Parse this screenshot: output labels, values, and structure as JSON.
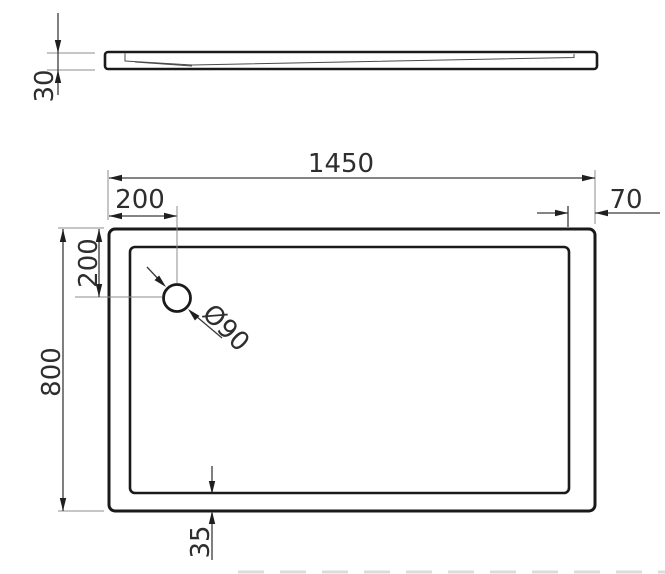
{
  "drawing": {
    "type": "technical-drawing",
    "subject": "rectangular shower tray, side profile and plan view with drain",
    "units_implied": "mm",
    "colors": {
      "background": "#ffffff",
      "outline": "#1a1a1a",
      "dimension_line": "#3a3a3a",
      "extension_line": "#8c8c8c",
      "text": "#2e2e2e"
    },
    "dimensions": {
      "side_thickness": "30",
      "overall_width": "1450",
      "drain_offset_x": "200",
      "drain_offset_y": "200",
      "overall_depth": "800",
      "right_rim": "70",
      "bottom_rim": "35",
      "drain_diameter": "Ø90"
    }
  }
}
